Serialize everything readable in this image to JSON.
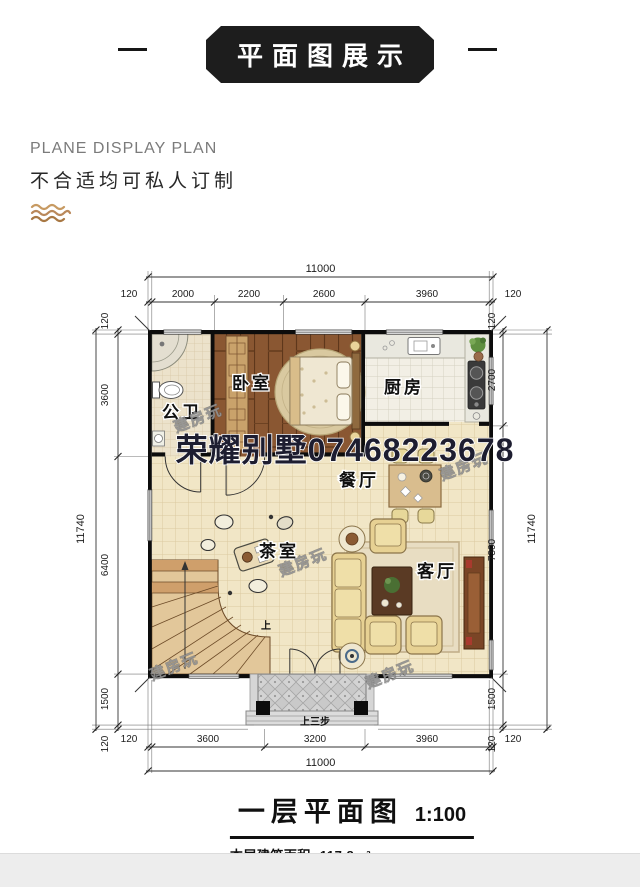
{
  "header": {
    "banner_title": "平面图展示"
  },
  "intro": {
    "subtitle_en": "PLANE DISPLAY PLAN",
    "subtitle_cn": "不合适均可私人订制",
    "wave_icon_color": "#b9885a"
  },
  "floor_plan": {
    "watermark_main": "荣耀别墅07468223678",
    "watermark_diagonal": "建房玩",
    "stair_up_label": "上",
    "entry_steps_label": "上三步",
    "rooms": [
      {
        "id": "bathroom",
        "label": "公卫"
      },
      {
        "id": "bedroom",
        "label": "卧室"
      },
      {
        "id": "kitchen",
        "label": "厨房"
      },
      {
        "id": "dining",
        "label": "餐厅"
      },
      {
        "id": "tea-room",
        "label": "茶室"
      },
      {
        "id": "living-room",
        "label": "客厅"
      }
    ],
    "dimensions": {
      "top": {
        "total": "11000",
        "segments": [
          "120",
          "2000",
          "2200",
          "2600",
          "3960",
          "120"
        ]
      },
      "bottom": {
        "total": "11000",
        "segments": [
          "120",
          "3600",
          "3200",
          "3960",
          "120"
        ]
      },
      "left": {
        "total": "11740",
        "segments": [
          "120",
          "3600",
          "6400",
          "1500",
          "120"
        ]
      },
      "right": {
        "total": "11740",
        "segments": [
          "120",
          "2700",
          "7300",
          "1500",
          "120"
        ]
      }
    },
    "colors": {
      "wall": "#0c0c0c",
      "floor_tile": "#f1e6c6",
      "wood": "#8a5732",
      "porch": "#c9c9c9"
    }
  },
  "caption": {
    "title": "一层平面图",
    "scale": "1:100",
    "area_label": "本层建筑面积:",
    "area_value": "117.8m²"
  }
}
